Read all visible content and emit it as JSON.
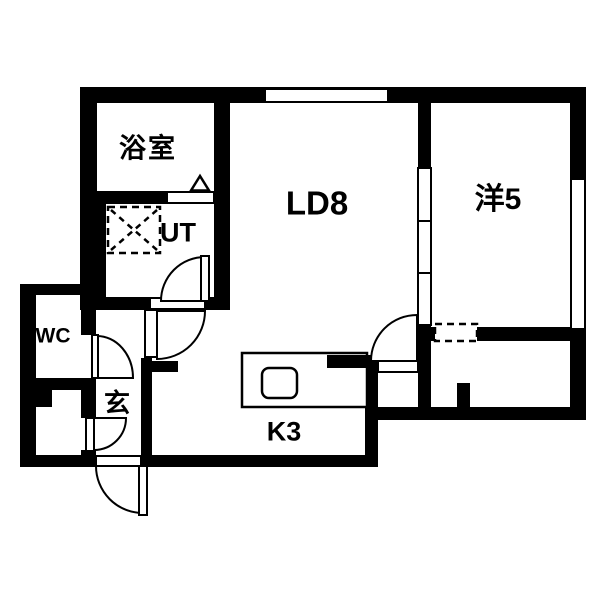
{
  "floorplan": {
    "type": "japanese-apartment-1LDK",
    "colors": {
      "wall": "#000000",
      "floor": "#ffffff",
      "line": "#000000"
    },
    "rooms": {
      "bathroom": {
        "label": "浴室"
      },
      "utility": {
        "label": "UT"
      },
      "living_dining": {
        "label": "LD8"
      },
      "western_room": {
        "label": "洋5"
      },
      "toilet": {
        "label": "WC"
      },
      "entrance": {
        "label": "玄"
      },
      "kitchen": {
        "label": "K3"
      }
    },
    "fixtures": [
      "washing-machine-space",
      "kitchen-counter",
      "kitchen-sink",
      "bathroom-folding-door-marker",
      "sliding-door-partition",
      "windows",
      "swing-doors"
    ]
  }
}
